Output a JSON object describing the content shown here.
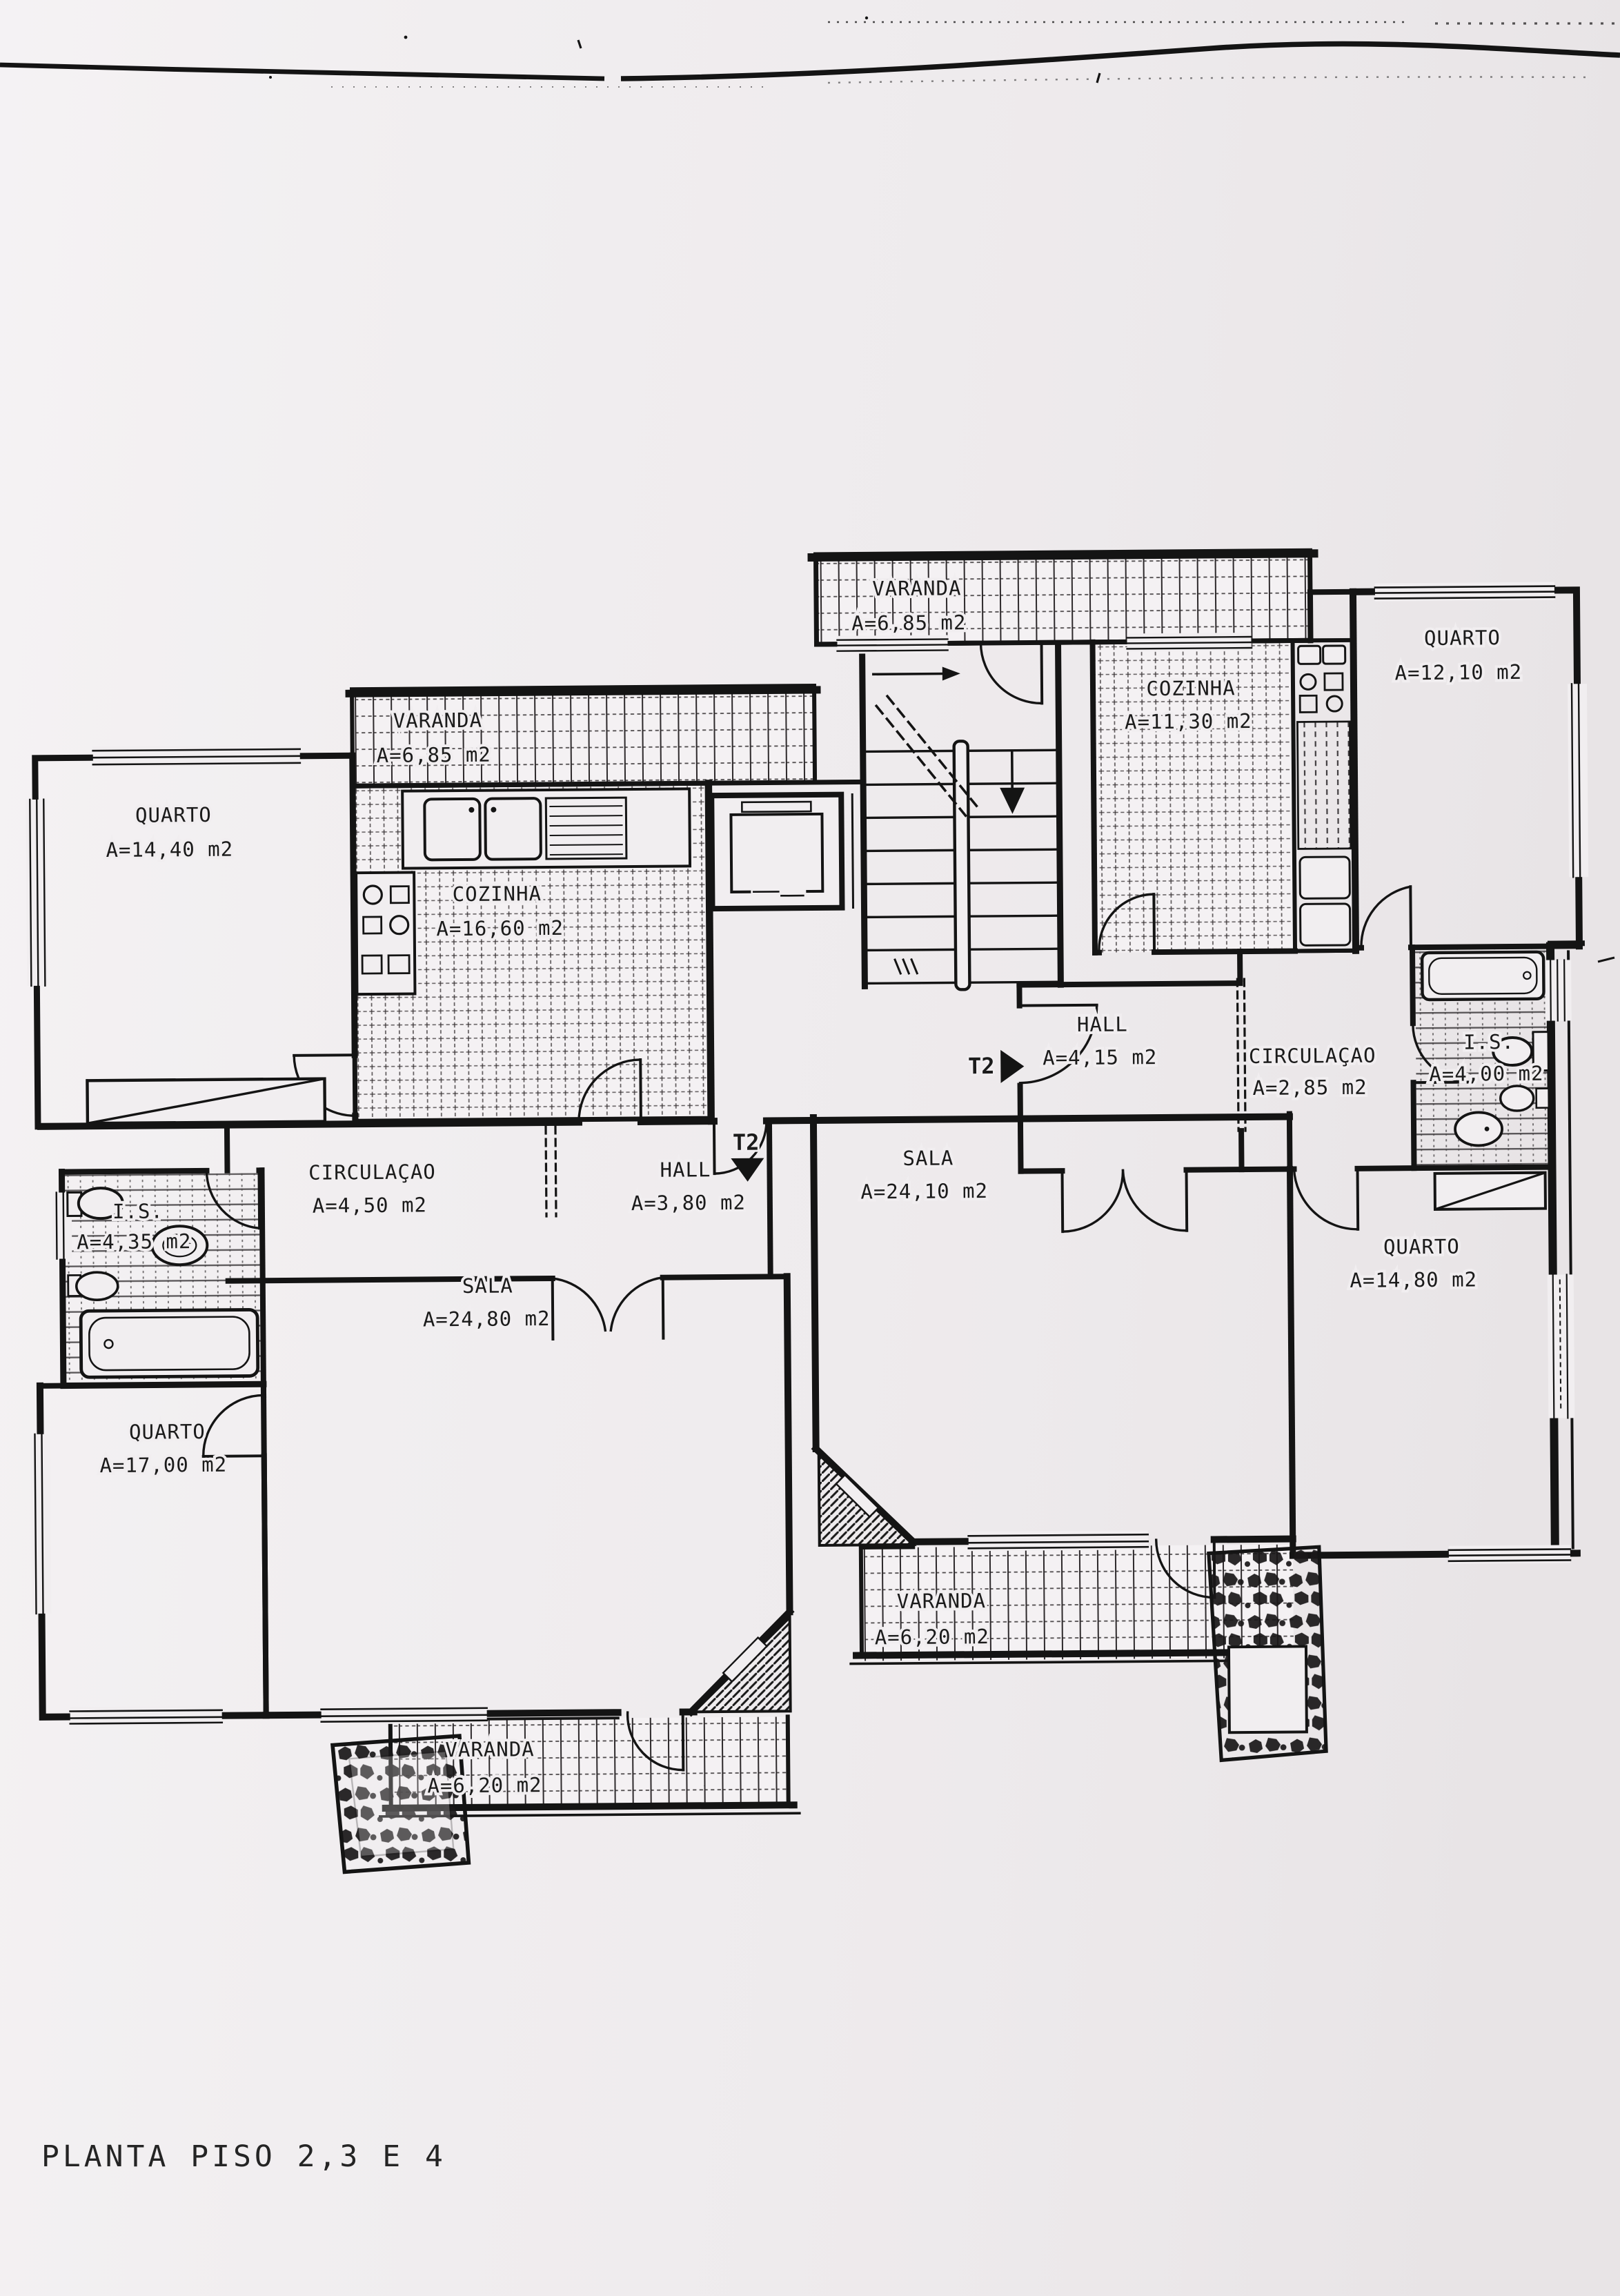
{
  "scan": {
    "title": "PLANTA PISO 2,3 E 4"
  },
  "plan": {
    "entries": [
      {
        "id": "right-apartment-entry",
        "label": "T2"
      },
      {
        "id": "left-apartment-entry",
        "label": "T2"
      }
    ],
    "rooms": [
      {
        "id": "varanda-top",
        "name": "VARANDA",
        "area": "A=6,85 m2"
      },
      {
        "id": "cozinha-right",
        "name": "COZINHA",
        "area": "A=11,30 m2"
      },
      {
        "id": "quarto-right-top",
        "name": "QUARTO",
        "area": "A=12,10 m2"
      },
      {
        "id": "varanda-left",
        "name": "VARANDA",
        "area": "A=6,85 m2"
      },
      {
        "id": "quarto-left-top",
        "name": "QUARTO",
        "area": "A=14,40 m2"
      },
      {
        "id": "cozinha-left",
        "name": "COZINHA",
        "area": "A=16,60 m2"
      },
      {
        "id": "hall-right",
        "name": "HALL",
        "area": "A=4,15 m2"
      },
      {
        "id": "circulacao-right",
        "name": "CIRCULAÇAO",
        "area": "A=2,85 m2"
      },
      {
        "id": "is-right",
        "name": "I.S.",
        "area": "A=4,00 m2"
      },
      {
        "id": "circulacao-left",
        "name": "CIRCULAÇAO",
        "area": "A=4,50 m2"
      },
      {
        "id": "hall-left",
        "name": "HALL",
        "area": "A=3,80 m2"
      },
      {
        "id": "sala-right",
        "name": "SALA",
        "area": "A=24,10 m2"
      },
      {
        "id": "is-left",
        "name": "I.S.",
        "area": "A=4,35 m2"
      },
      {
        "id": "sala-left",
        "name": "SALA",
        "area": "A=24,80 m2"
      },
      {
        "id": "quarto-left-bottom",
        "name": "QUARTO",
        "area": "A=17,00 m2"
      },
      {
        "id": "quarto-right-bottom",
        "name": "QUARTO",
        "area": "A=14,80 m2"
      },
      {
        "id": "varanda-right-bottom",
        "name": "VARANDA",
        "area": "A=6,20 m2"
      },
      {
        "id": "varanda-left-bottom",
        "name": "VARANDA",
        "area": "A=6,20 m2"
      }
    ]
  }
}
